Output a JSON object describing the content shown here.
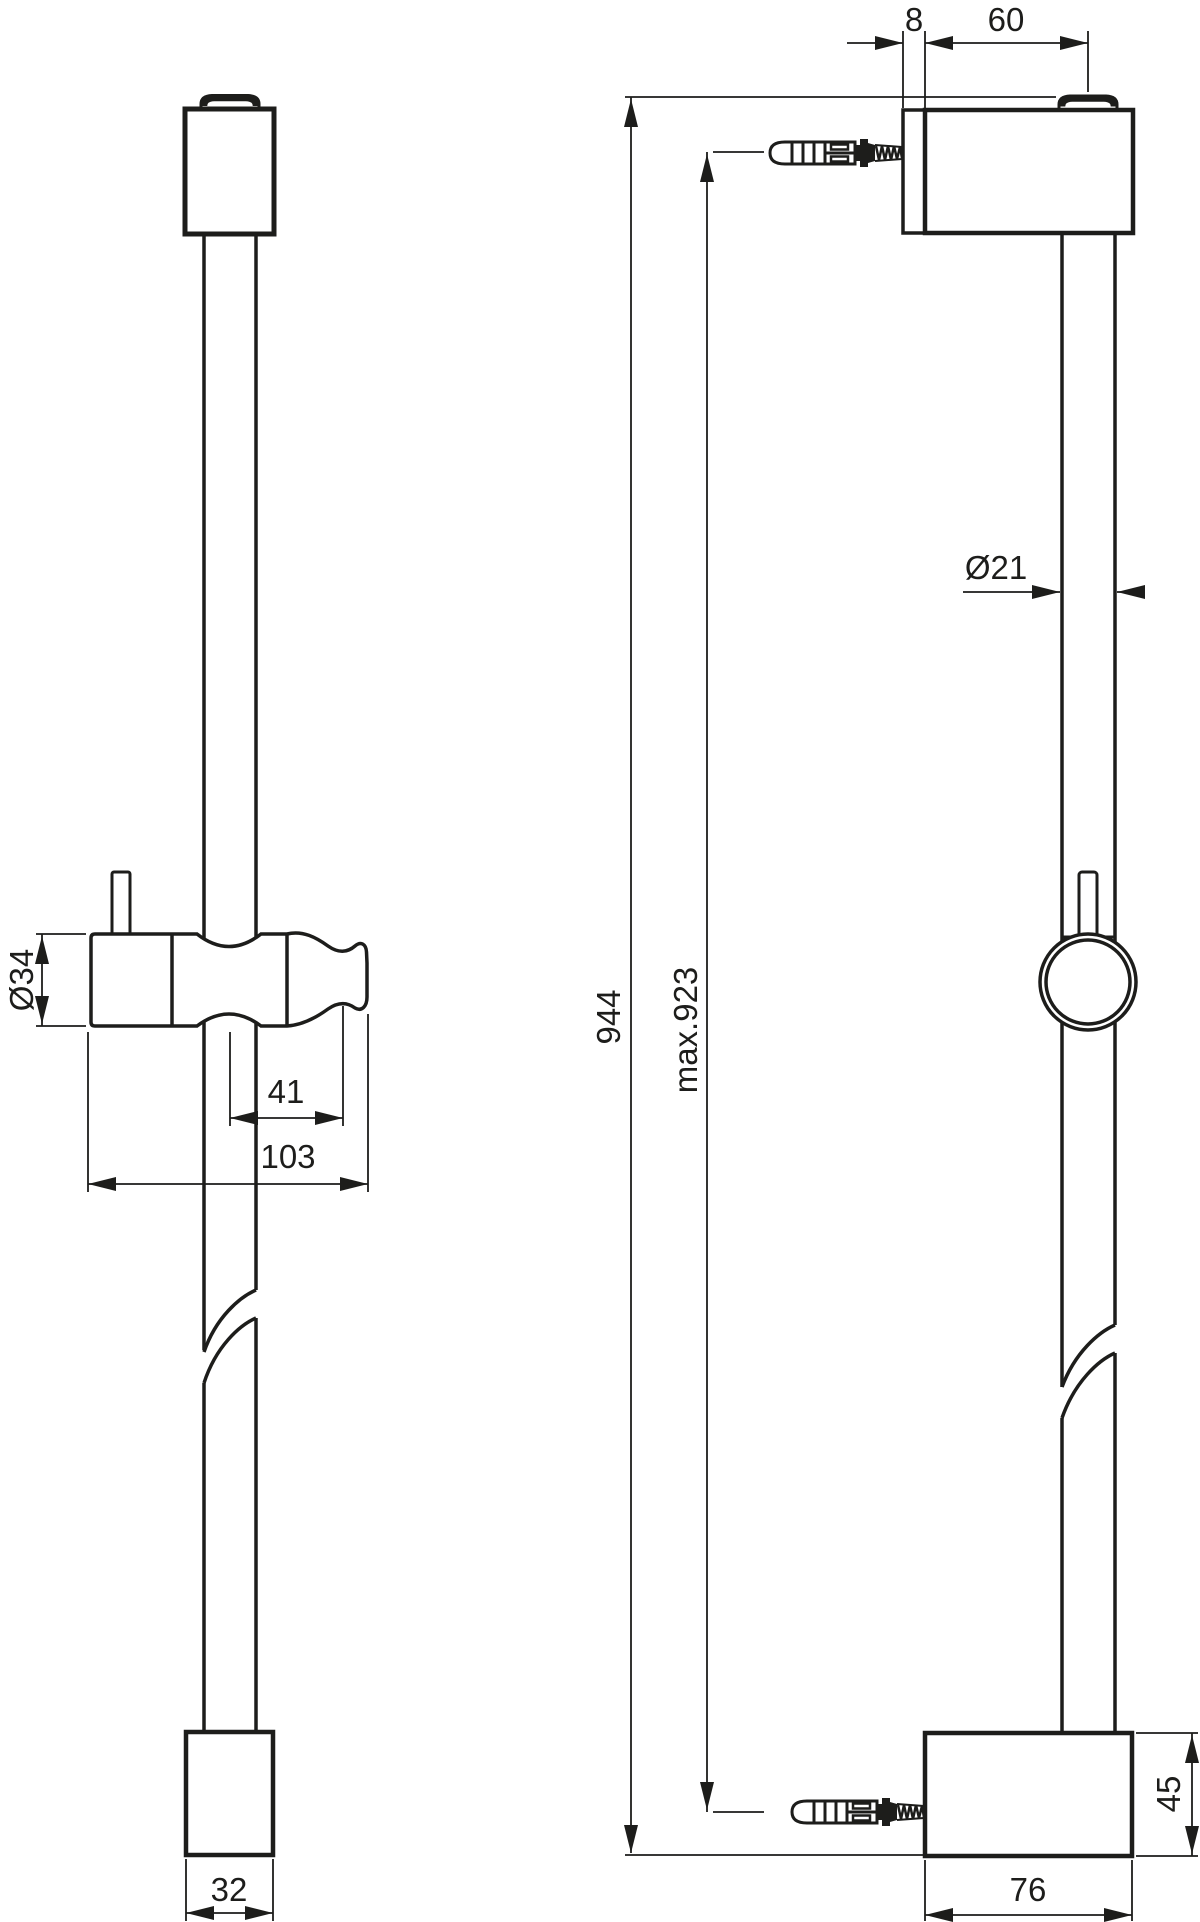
{
  "drawing": {
    "type": "technical-dimension-drawing",
    "subject": "shower slide rail bar, front and side views with wall plugs",
    "background_color": "#ffffff",
    "line_color": "#1d1d1b",
    "views": {
      "front": {
        "name": "front view"
      },
      "side": {
        "name": "side view"
      }
    },
    "dimensions": {
      "plate_thickness": "8",
      "bracket_depth": "60",
      "rail_diameter": "Ø21",
      "slider_diameter": "Ø34",
      "holder_offset": "41",
      "holder_length": "103",
      "overall_height": "944",
      "max_hole_distance": "max.923",
      "bottom_bracket_height": "45",
      "bottom_cap_width": "32",
      "bottom_bracket_depth": "76"
    }
  }
}
